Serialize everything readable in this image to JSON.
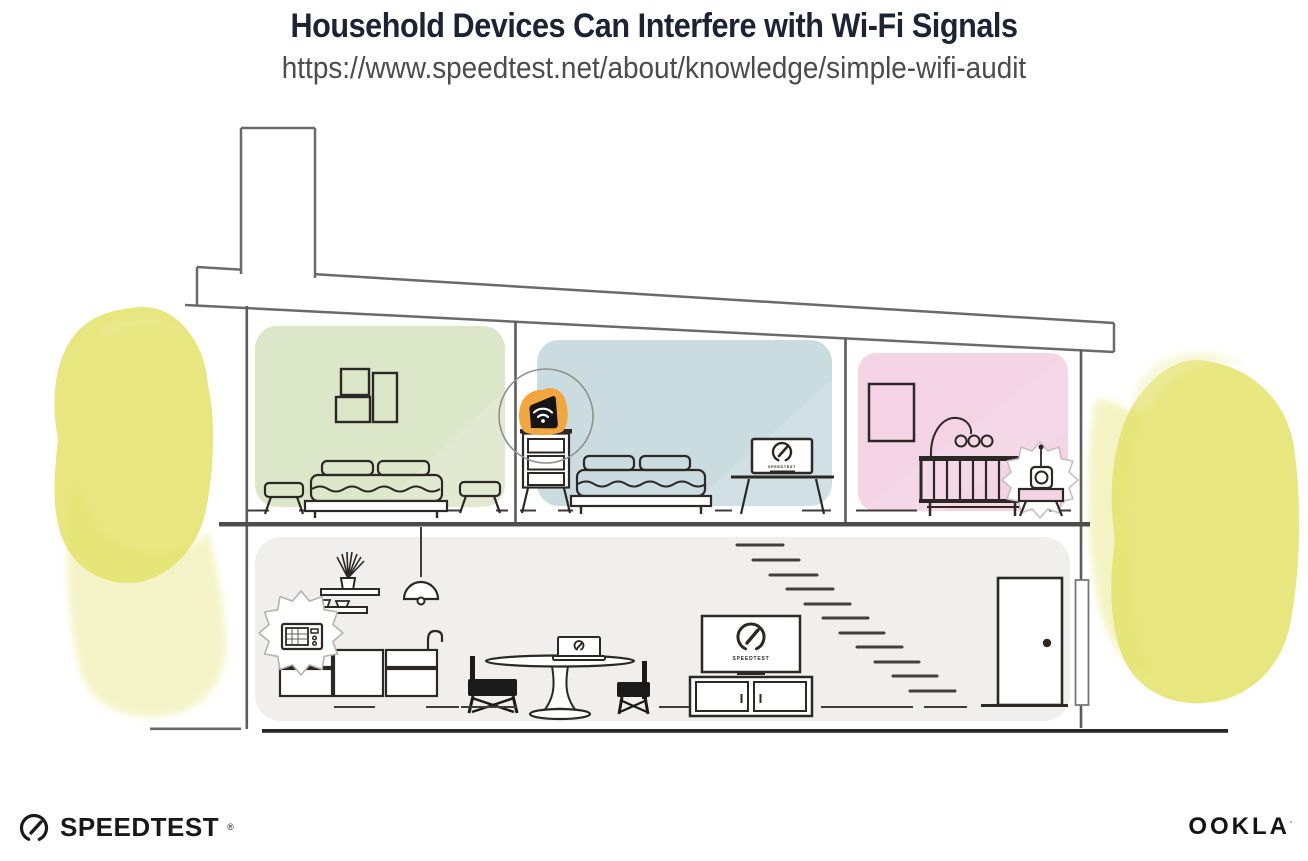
{
  "page": {
    "title": "Household Devices Can Interfere with Wi-Fi Signals",
    "url": "https://www.speedtest.net/about/knowledge/simple-wifi-audit"
  },
  "devices": {
    "tv_screen_label": "SPEEDTEST",
    "bedroom_laptop_label": "SPEEDTEST"
  },
  "footer": {
    "speedtest_wordmark": "SPEEDTEST",
    "speedtest_registered": "®",
    "ookla_wordmark": "OOKLA",
    "ookla_registered": "’"
  },
  "colors": {
    "title_ink": "#1c2433",
    "url_gray": "#4c4c4c",
    "structure_line_gray": "#6a6a6a",
    "furniture_ink": "#2b2825",
    "room_green": "#dce7ca",
    "room_blue": "#cadce0",
    "room_pink": "#f3d3e4",
    "ground_floor_gray": "#f0efed",
    "router_orange": "#f2a63e",
    "foliage_yellow": "#e4e26d",
    "foliage_yellow_light": "#f0efad"
  }
}
